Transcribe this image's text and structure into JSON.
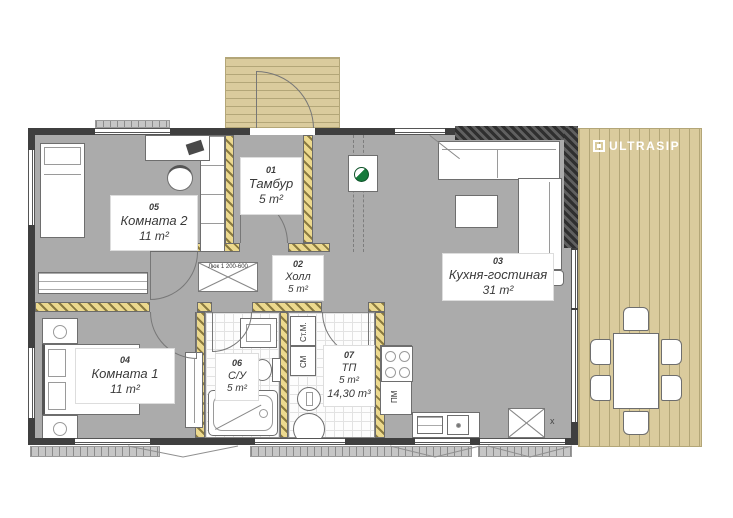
{
  "branding": {
    "logo_text": "ULTRASIP"
  },
  "rooms": [
    {
      "num": "05",
      "name": "Комната 2",
      "area": "11 m²"
    },
    {
      "num": "01",
      "name": "Тамбур",
      "area": "5 m²"
    },
    {
      "num": "02",
      "name": "Холл",
      "area": "5 m²"
    },
    {
      "num": "03",
      "name": "Кухня-гостиная",
      "area": "31 m²"
    },
    {
      "num": "04",
      "name": "Комната 1",
      "area": "11 m²"
    },
    {
      "num": "06",
      "name": "С/У",
      "area": "5 m²"
    },
    {
      "num": "07",
      "name": "ТП",
      "area": "5 m²",
      "volume": "14,30 m³"
    }
  ],
  "annotations": {
    "washer": "Ст.М.",
    "dryer": "СМ",
    "dishwasher": "ПМ",
    "ceiling_hatch": "Люк 1 200-600",
    "x_mark": "x"
  },
  "colors": {
    "deck": "#dacb9d",
    "deck_line": "#b3a678",
    "outer_wall": "#3f3f3f",
    "floor_gray": "#ababab",
    "insulation_yellow": "#ecd98e",
    "panel_green": "#157a3b",
    "logo_text": "#ffffff"
  }
}
